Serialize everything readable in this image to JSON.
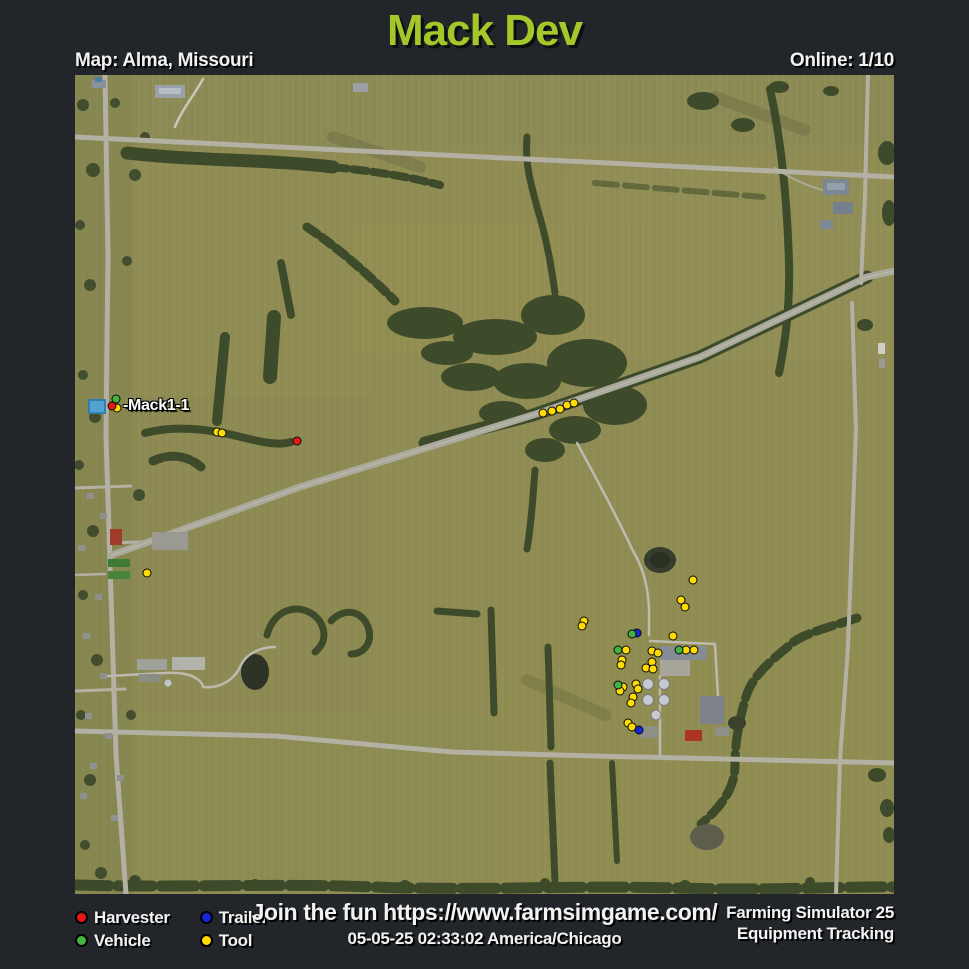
{
  "header": {
    "title": "Mack Dev",
    "map_label": "Map: Alma, Missouri",
    "online_label": "Online: 1/10"
  },
  "colors": {
    "background": "#22262a",
    "title_green": "#a4c72a",
    "field_olive": "#8e8b53",
    "harvester": "#e61717",
    "vehicle": "#43b440",
    "trailer": "#1526d8",
    "tool": "#ffdc00"
  },
  "map": {
    "player_label": "-Mack1-1",
    "marker_groups": [
      {
        "type": "tool",
        "color": "#ffdc00",
        "points": [
          [
            42,
            333
          ],
          [
            142,
            357
          ],
          [
            147,
            358
          ],
          [
            468,
            338
          ],
          [
            477,
            336
          ],
          [
            485,
            334
          ],
          [
            492,
            330
          ],
          [
            499,
            328
          ],
          [
            72,
            498
          ],
          [
            509,
            546
          ],
          [
            507,
            551
          ],
          [
            618,
            505
          ],
          [
            606,
            525
          ],
          [
            610,
            532
          ],
          [
            598,
            561
          ],
          [
            551,
            575
          ],
          [
            547,
            585
          ],
          [
            546,
            590
          ],
          [
            577,
            576
          ],
          [
            583,
            578
          ],
          [
            577,
            587
          ],
          [
            571,
            593
          ],
          [
            578,
            594
          ],
          [
            611,
            575
          ],
          [
            619,
            575
          ],
          [
            561,
            609
          ],
          [
            563,
            614
          ],
          [
            548,
            612
          ],
          [
            545,
            616
          ],
          [
            558,
            622
          ],
          [
            556,
            628
          ],
          [
            553,
            648
          ],
          [
            557,
            652
          ]
        ]
      },
      {
        "type": "trailer",
        "color": "#1526d8",
        "points": [
          [
            562,
            558
          ],
          [
            564,
            655
          ]
        ]
      },
      {
        "type": "vehicle",
        "color": "#43b440",
        "points": [
          [
            543,
            610
          ],
          [
            557,
            559
          ],
          [
            543,
            575
          ],
          [
            604,
            575
          ],
          [
            41,
            324
          ]
        ]
      },
      {
        "type": "harvester",
        "color": "#e61717",
        "points": [
          [
            37,
            331
          ],
          [
            222,
            366
          ]
        ]
      }
    ]
  },
  "legend": {
    "items": [
      {
        "label": "Harvester",
        "color": "#e61717"
      },
      {
        "label": "Vehicle",
        "color": "#43b440"
      },
      {
        "label": "Trailer",
        "color": "#1526d8"
      },
      {
        "label": "Tool",
        "color": "#ffdc00"
      }
    ]
  },
  "footer": {
    "promo": "Join the fun https://www.farmsimgame.com/",
    "timestamp": "05-05-25 02:33:02 America/Chicago",
    "credit_line1": "Farming Simulator 25",
    "credit_line2": "Equipment Tracking"
  }
}
